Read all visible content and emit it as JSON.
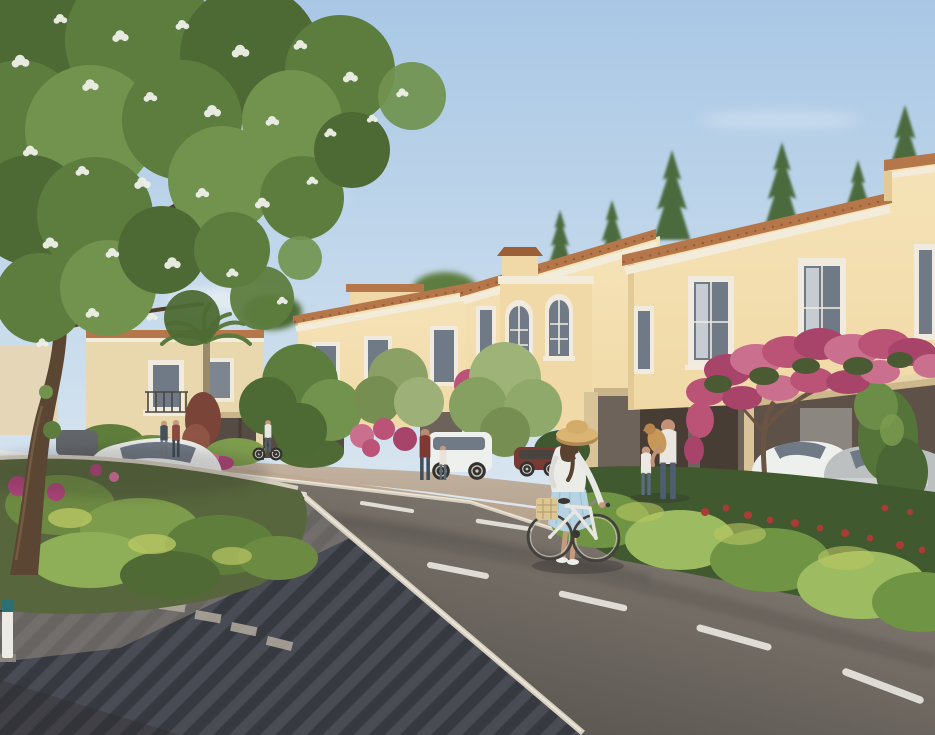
{
  "meta": {
    "title": "Residential community street — architectural rendering",
    "caption": "Photorealistic rendering of a Mediterranean-style townhouse community: cream stucco villas with terracotta roof copings line a curving asphalt street with dashed lane markings. A woman in a straw hat and light-blue skirt walks a white bicycle with a basket across the road. On the far sidewalk a man in a white t-shirt holds a golden puppy while a little girl reaches up. Cars are parked along the street and under a carport draped with pink bougainvillea. A large blossoming tree frames the top-left against a soft blue sky."
  },
  "scene": {
    "objects": [
      "sky",
      "clouds",
      "flowering-tree",
      "townhouse-right",
      "townhouse-arched",
      "townhouse-center",
      "villa-background",
      "palm-trees",
      "conifer-trees",
      "carport",
      "bougainvillea",
      "hedges",
      "planting-bed",
      "road",
      "lane-markings",
      "paved-sidewalk",
      "promenade",
      "woman-with-bicycle",
      "family-with-puppy",
      "pedestrians",
      "cyclist",
      "white-sedan",
      "white-suv",
      "white-sports-car",
      "silver-sports-car",
      "dark-red-car",
      "bollard"
    ]
  },
  "colors": {
    "skyTop": "#a9c7e5",
    "skyMid": "#cfe0ee",
    "skyLow": "#e8eef2",
    "cloud": "#f5f7f7",
    "facade": "#f0d9a6",
    "facadeLight": "#f5e3b8",
    "facadeShade": "#e3c994",
    "facadeDistant": "#e9d7ae",
    "facadeFar": "#e5d5b3",
    "coping": "#b5764a",
    "copingDark": "#8f5a36",
    "copingHip": "#9c6038",
    "cornice": "#f3ecdb",
    "frame": "#f0ebde",
    "glass": "#707a86",
    "glassLight": "#a9b2ba",
    "curtain": "#dde1e6",
    "recess": "#6e635a",
    "door": "#473d35",
    "beam": "#c9b489",
    "pillar": "#d8c498",
    "carport": "#5e5148",
    "panel": "#8b8680",
    "awning": "#e6d6ac",
    "awningEdge": "#cdb88c",
    "balcony": "#4a4540",
    "storefront": "#554c44",
    "promA": "#c6b09a",
    "promB": "#a3917c",
    "curb": "#d6cfc0",
    "curbLight": "#ece6d8",
    "concrete": "#b7ab99",
    "roadLight": "#8d867b",
    "roadMid": "#6e6861",
    "roadDark": "#4e4a45",
    "shadow": "#2e2c2a",
    "lane": "#ebe9e2",
    "paveBase": "#3f4149",
    "paveA": "#4a4c55",
    "paveB": "#373941",
    "paveLit": "#9a9084",
    "bedBase": "#57663c",
    "g1": "#6d8a42",
    "g2": "#7d9c4c",
    "g3": "#5f7e3c",
    "g4": "#8fae58",
    "g5": "#4f6a34",
    "gLight": "#b9c764",
    "hedge": "#6f9444",
    "hedgeLight": "#9dbb60",
    "hedgeDark": "#41592f",
    "treeDark": "#4d6a34",
    "treeMid": "#5d7d3f",
    "treeLight": "#71934e",
    "blossom": "#eef0e8",
    "trunk": "#5a4632",
    "trunkLight": "#7b6248",
    "branch": "#4f3d2b",
    "conifer": "#4b6a3c",
    "palmFrond": "#5d7a3e",
    "palmTrunk": "#9a8a6a",
    "pinkA": "#bb5377",
    "pinkB": "#a8436a",
    "pinkC": "#cb6f8e",
    "magenta": "#b0437a",
    "magentaLight": "#d66f9e",
    "leafDark": "#4a5a33",
    "redFlower": "#a93c34",
    "carWhite": "#eef0ee",
    "carSilver": "#bcc0c0",
    "carDark": "#62666a",
    "carRed": "#7a3a34",
    "tire": "#34322e",
    "rim": "#c9c7c0",
    "skin": "#c79a7e",
    "hat": "#d9b472",
    "hatShade": "#b08952",
    "hair": "#5a4230",
    "topWhite": "#ebebe7",
    "skirt": "#b5d3e2",
    "skirtFold": "#9dc0d2",
    "basket": "#dcc794",
    "basketLine": "#b09a6a",
    "dogTan": "#c89858",
    "dogHead": "#b8864c"
  }
}
